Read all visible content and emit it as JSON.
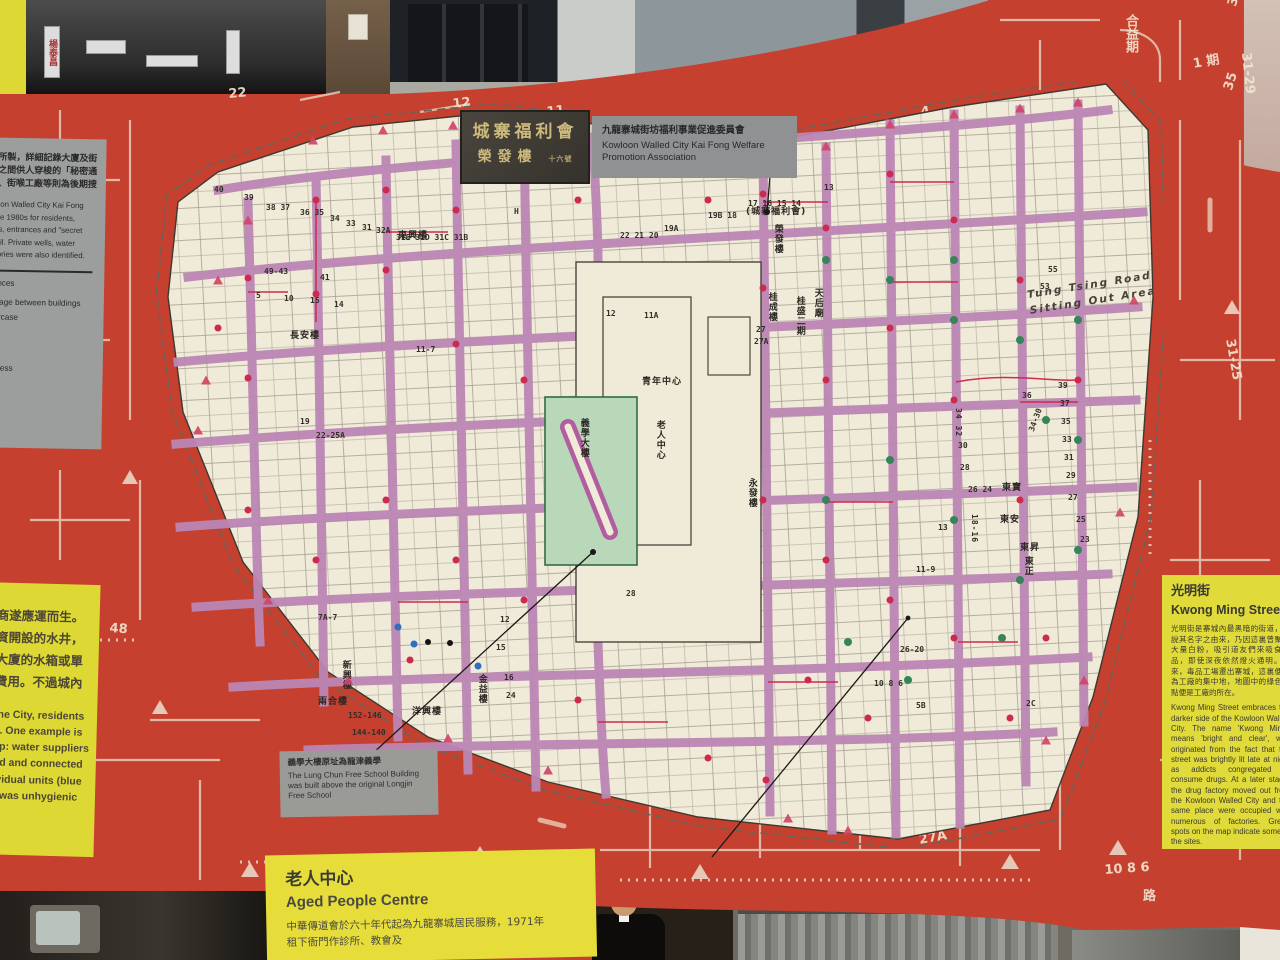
{
  "palette": {
    "red_bg": "#c5402e",
    "map_paper": "#f0ead8",
    "lane_purple": "#bb86b4",
    "dot_red": "#cc2a50",
    "dot_green": "#35845a",
    "dot_blue": "#2e6fc2",
    "panel_yellow": "#ddd834",
    "panel_gray": "#9c9e9e",
    "line_white": "#ecdfcd"
  },
  "top_photos": {
    "street_sign": "楊泰昌"
  },
  "sign": {
    "stone_line1": "城寨福利會",
    "stone_line2": "榮發樓",
    "stone_suffix": "十六號",
    "label_zh": "九龍寨城街坊福利事業促進委員會",
    "label_en": "Kowloon Walled City Kai Fong Welfare Promotion Association"
  },
  "left_panel": {
    "intro_zh": [
      "會於八十年代所製，詳細記錄大廈及街",
      "入口以及樓宇之間供人穿梭的「秘密通",
      "入。水井水箱、街喉工廠等則為後期搜"
    ],
    "intro_en": [
      "wn by the Kowloon Walled City Kai Fong",
      "Association in the 1980s for residents,",
      "dings and streets, entrances and \"secret",
      "ll marked in detail.  Private wells, water",
      "access and factories were also identified."
    ],
    "legend": [
      {
        "zh": "",
        "en": "Building entrances"
      },
      {
        "zh": "穿梭通道",
        "en": "Passage between buildings"
      },
      {
        "zh": "",
        "en": "ntrance of staircase"
      },
      {
        "zh": "",
        "en": "rivate well"
      },
      {
        "zh": "",
        "en": "ater tank"
      },
      {
        "zh": "",
        "en": "ublic water access"
      },
      {
        "zh": "",
        "en": "y"
      }
    ]
  },
  "left_lower_panel": {
    "zh": [
      "商遂應運而生。",
      "資開設的水井，",
      "大廈的水箱或單",
      "費用。不過城內"
    ],
    "en": [
      "the City, residents",
      "s. One example is",
      "ap: water suppliers",
      "nd and connected",
      "ividual units (blue",
      "r was unhygienic"
    ]
  },
  "right_panel": {
    "title_zh": "光明街",
    "title_en": "Kwong Ming Street",
    "body_zh": "光明街是寨城內最黑暗的街道，有說其名字之由來，乃因這裏曾聚有大量白粉，吸引道友們來吸食毒品，即使深夜依然燈火通明。後來，毒品工場遷出寨城，這裏便成為工廠的集中地，地圖中的綠色圓點便是工廠的所在。",
    "body_en": "Kwong Ming Street embraces the darker side of the Kowloon Walled City. The name 'Kwong Ming', means 'bright and clear', was originated from the fact that the street was brightly lit late at night as addicts congregated to consume drugs. At a later stage, the drug factory moved out from the Kowloon Walled City and the same place were occupied with numerous of factories. Green spots on the map indicate some of the sites."
  },
  "bottom_panel": {
    "title_zh": "老人中心",
    "title_en": "Aged People Centre",
    "body": [
      "中華傳道會於六十年代起為九龍寨城居民服務，1971年",
      "租下衙門作診所、教會及"
    ]
  },
  "lungchun_label": {
    "zh": "義學大樓原址為龍津義學",
    "en": "The Lung Chun Free School Building was built above the original Longjin Free School"
  },
  "map": {
    "annotation_tung_tsing": [
      "Tung Tsing Road",
      "Sitting Out Area"
    ],
    "numbers": [
      {
        "t": "40",
        "x": 66,
        "y": 104
      },
      {
        "t": "39",
        "x": 96,
        "y": 112
      },
      {
        "t": "38 37",
        "x": 118,
        "y": 122
      },
      {
        "t": "36 35",
        "x": 152,
        "y": 127
      },
      {
        "t": "34",
        "x": 182,
        "y": 133
      },
      {
        "t": "33",
        "x": 198,
        "y": 138
      },
      {
        "t": "31",
        "x": 214,
        "y": 142
      },
      {
        "t": "32A",
        "x": 228,
        "y": 145
      },
      {
        "t": "31E 31D 31C 31B",
        "x": 248,
        "y": 152
      },
      {
        "t": "49-43",
        "x": 116,
        "y": 186
      },
      {
        "t": "41",
        "x": 172,
        "y": 192
      },
      {
        "t": "5",
        "x": 108,
        "y": 210
      },
      {
        "t": "10",
        "x": 136,
        "y": 213
      },
      {
        "t": "15",
        "x": 162,
        "y": 215
      },
      {
        "t": "14",
        "x": 186,
        "y": 219
      },
      {
        "t": "19",
        "x": 152,
        "y": 336
      },
      {
        "t": "22-25A",
        "x": 168,
        "y": 350
      },
      {
        "t": "11-7",
        "x": 268,
        "y": 264
      },
      {
        "t": "H",
        "x": 366,
        "y": 126
      },
      {
        "t": "22 21 20",
        "x": 472,
        "y": 150
      },
      {
        "t": "19A",
        "x": 516,
        "y": 143
      },
      {
        "t": "19B 18",
        "x": 560,
        "y": 130
      },
      {
        "t": "17 16 15 14",
        "x": 600,
        "y": 118
      },
      {
        "t": "13",
        "x": 676,
        "y": 102
      },
      {
        "t": "12",
        "x": 458,
        "y": 228
      },
      {
        "t": "11A",
        "x": 496,
        "y": 230
      },
      {
        "t": "27",
        "x": 608,
        "y": 244
      },
      {
        "t": "27A",
        "x": 606,
        "y": 256
      },
      {
        "t": "28",
        "x": 478,
        "y": 508
      },
      {
        "t": "55",
        "x": 900,
        "y": 184
      },
      {
        "t": "53",
        "x": 892,
        "y": 201
      },
      {
        "t": "39",
        "x": 910,
        "y": 300
      },
      {
        "t": "37",
        "x": 912,
        "y": 318
      },
      {
        "t": "35",
        "x": 913,
        "y": 336
      },
      {
        "t": "33",
        "x": 914,
        "y": 354
      },
      {
        "t": "31",
        "x": 916,
        "y": 372
      },
      {
        "t": "29",
        "x": 918,
        "y": 390
      },
      {
        "t": "27",
        "x": 920,
        "y": 412
      },
      {
        "t": "25",
        "x": 928,
        "y": 434
      },
      {
        "t": "23",
        "x": 932,
        "y": 454
      },
      {
        "t": "34-30",
        "x": 880,
        "y": 348,
        "r": -70
      },
      {
        "t": "36",
        "x": 874,
        "y": 310
      },
      {
        "t": "34 32",
        "x": 806,
        "y": 326,
        "v": 1
      },
      {
        "t": "30",
        "x": 810,
        "y": 360
      },
      {
        "t": "28",
        "x": 812,
        "y": 382
      },
      {
        "t": "26 24",
        "x": 820,
        "y": 404
      },
      {
        "t": "18-16",
        "x": 822,
        "y": 432,
        "v": 1
      },
      {
        "t": "13",
        "x": 790,
        "y": 442
      },
      {
        "t": "11-9",
        "x": 768,
        "y": 484
      },
      {
        "t": "26-20",
        "x": 752,
        "y": 564
      },
      {
        "t": "10 8 6",
        "x": 726,
        "y": 598
      },
      {
        "t": "5B",
        "x": 768,
        "y": 620
      },
      {
        "t": "2C",
        "x": 878,
        "y": 618
      },
      {
        "t": "152-146",
        "x": 200,
        "y": 630
      },
      {
        "t": "144-140",
        "x": 204,
        "y": 647
      },
      {
        "t": "7A-7",
        "x": 170,
        "y": 532
      },
      {
        "t": "12",
        "x": 352,
        "y": 534
      },
      {
        "t": "15",
        "x": 348,
        "y": 562
      },
      {
        "t": "16",
        "x": 356,
        "y": 592
      },
      {
        "t": "24",
        "x": 358,
        "y": 610
      }
    ],
    "labels": [
      {
        "t": "東興樓",
        "x": 250,
        "y": 150
      },
      {
        "t": "長安樓",
        "x": 142,
        "y": 250
      },
      {
        "t": "天后廟",
        "x": 664,
        "y": 206,
        "v": 1
      },
      {
        "t": "桂成樓",
        "x": 618,
        "y": 210,
        "v": 1
      },
      {
        "t": "桂盛二期",
        "x": 646,
        "y": 214,
        "v": 1
      },
      {
        "t": "(城寨福利會)",
        "x": 598,
        "y": 126
      },
      {
        "t": "榮發樓",
        "x": 624,
        "y": 142,
        "v": 1
      },
      {
        "t": "永發樓",
        "x": 598,
        "y": 396,
        "v": 1
      },
      {
        "t": "義學大樓",
        "x": 430,
        "y": 336,
        "v": 1
      },
      {
        "t": "老人中心",
        "x": 506,
        "y": 338,
        "v": 1
      },
      {
        "t": "青年中心",
        "x": 494,
        "y": 296
      },
      {
        "t": "新興樓",
        "x": 192,
        "y": 578,
        "v": 1
      },
      {
        "t": "兩合樓",
        "x": 170,
        "y": 616
      },
      {
        "t": "洋興樓",
        "x": 264,
        "y": 626
      },
      {
        "t": "金益樓",
        "x": 328,
        "y": 592,
        "v": 1
      },
      {
        "t": "東正",
        "x": 874,
        "y": 474,
        "v": 1
      },
      {
        "t": "東寶",
        "x": 854,
        "y": 402
      },
      {
        "t": "東安",
        "x": 852,
        "y": 434
      },
      {
        "t": "東昇",
        "x": 872,
        "y": 462
      }
    ],
    "dots": {
      "red": [
        [
          168,
          118
        ],
        [
          168,
          212
        ],
        [
          238,
          108
        ],
        [
          238,
          188
        ],
        [
          308,
          128
        ],
        [
          308,
          262
        ],
        [
          376,
          98
        ],
        [
          376,
          298
        ],
        [
          100,
          196
        ],
        [
          100,
          296
        ],
        [
          70,
          246
        ],
        [
          615,
          112
        ],
        [
          615,
          206
        ],
        [
          678,
          146
        ],
        [
          678,
          298
        ],
        [
          742,
          92
        ],
        [
          742,
          246
        ],
        [
          806,
          138
        ],
        [
          806,
          318
        ],
        [
          872,
          198
        ],
        [
          872,
          418
        ],
        [
          930,
          298
        ],
        [
          615,
          418
        ],
        [
          678,
          478
        ],
        [
          742,
          518
        ],
        [
          806,
          556
        ],
        [
          660,
          598
        ],
        [
          720,
          636
        ],
        [
          238,
          418
        ],
        [
          308,
          478
        ],
        [
          376,
          518
        ],
        [
          168,
          478
        ],
        [
          100,
          428
        ],
        [
          430,
          618
        ],
        [
          560,
          676
        ],
        [
          618,
          698
        ],
        [
          862,
          636
        ],
        [
          898,
          556
        ],
        [
          430,
          118
        ],
        [
          500,
          92
        ],
        [
          560,
          118
        ],
        [
          262,
          578
        ]
      ],
      "green": [
        [
          678,
          178
        ],
        [
          742,
          198
        ],
        [
          806,
          178
        ],
        [
          872,
          258
        ],
        [
          930,
          358
        ],
        [
          898,
          338
        ],
        [
          742,
          378
        ],
        [
          806,
          438
        ],
        [
          872,
          498
        ],
        [
          930,
          468
        ],
        [
          678,
          418
        ],
        [
          806,
          238
        ],
        [
          930,
          238
        ],
        [
          854,
          556
        ],
        [
          760,
          598
        ],
        [
          700,
          560
        ]
      ],
      "blue": [
        [
          250,
          545
        ],
        [
          266,
          562
        ],
        [
          330,
          584
        ]
      ],
      "black": [
        [
          280,
          560
        ],
        [
          302,
          561
        ],
        [
          445,
          470
        ],
        [
          619,
          130
        ]
      ]
    },
    "triangles": [
      [
        165,
        58
      ],
      [
        235,
        48
      ],
      [
        305,
        43
      ],
      [
        376,
        38
      ],
      [
        100,
        138
      ],
      [
        70,
        198
      ],
      [
        615,
        72
      ],
      [
        678,
        64
      ],
      [
        742,
        42
      ],
      [
        806,
        32
      ],
      [
        872,
        26
      ],
      [
        930,
        20
      ],
      [
        58,
        298
      ],
      [
        50,
        348
      ],
      [
        936,
        598
      ],
      [
        898,
        658
      ],
      [
        640,
        736
      ],
      [
        700,
        748
      ],
      [
        400,
        688
      ],
      [
        300,
        656
      ],
      [
        200,
        598
      ],
      [
        120,
        518
      ],
      [
        986,
        218
      ],
      [
        972,
        430
      ],
      [
        540,
        86
      ],
      [
        450,
        62
      ]
    ]
  },
  "background_numbers": [
    {
      "t": "12",
      "x": 452,
      "y": 98,
      "r": -6
    },
    {
      "t": "11",
      "x": 546,
      "y": 106,
      "r": -6
    },
    {
      "t": "4",
      "x": 920,
      "y": 106,
      "r": -8
    },
    {
      "t": "3",
      "x": 976,
      "y": 110,
      "r": -8
    },
    {
      "t": "合益期",
      "x": 1124,
      "y": 14,
      "v": 1
    },
    {
      "t": "1 期",
      "x": 1192,
      "y": 58,
      "r": -10
    },
    {
      "t": "35",
      "x": 1222,
      "y": 88,
      "r": -72
    },
    {
      "t": "37",
      "x": 1226,
      "y": 4,
      "r": -72
    },
    {
      "t": "31-29",
      "x": 1252,
      "y": 52,
      "r": 84
    },
    {
      "t": "31-25",
      "x": 1236,
      "y": 338,
      "r": 80
    },
    {
      "t": "48",
      "x": 110,
      "y": 622,
      "r": 4
    },
    {
      "t": "22",
      "x": 228,
      "y": 88,
      "r": -5
    },
    {
      "t": "29",
      "x": 742,
      "y": 770,
      "r": -10
    },
    {
      "t": "27A",
      "x": 918,
      "y": 834,
      "r": -10
    },
    {
      "t": "26-20",
      "x": 884,
      "y": 822,
      "r": -12
    },
    {
      "t": "10 8 6",
      "x": 1104,
      "y": 864,
      "r": -4
    },
    {
      "t": "路",
      "x": 1143,
      "y": 890
    },
    {
      "t": "期",
      "x": 3,
      "y": 146,
      "v": 1
    }
  ]
}
